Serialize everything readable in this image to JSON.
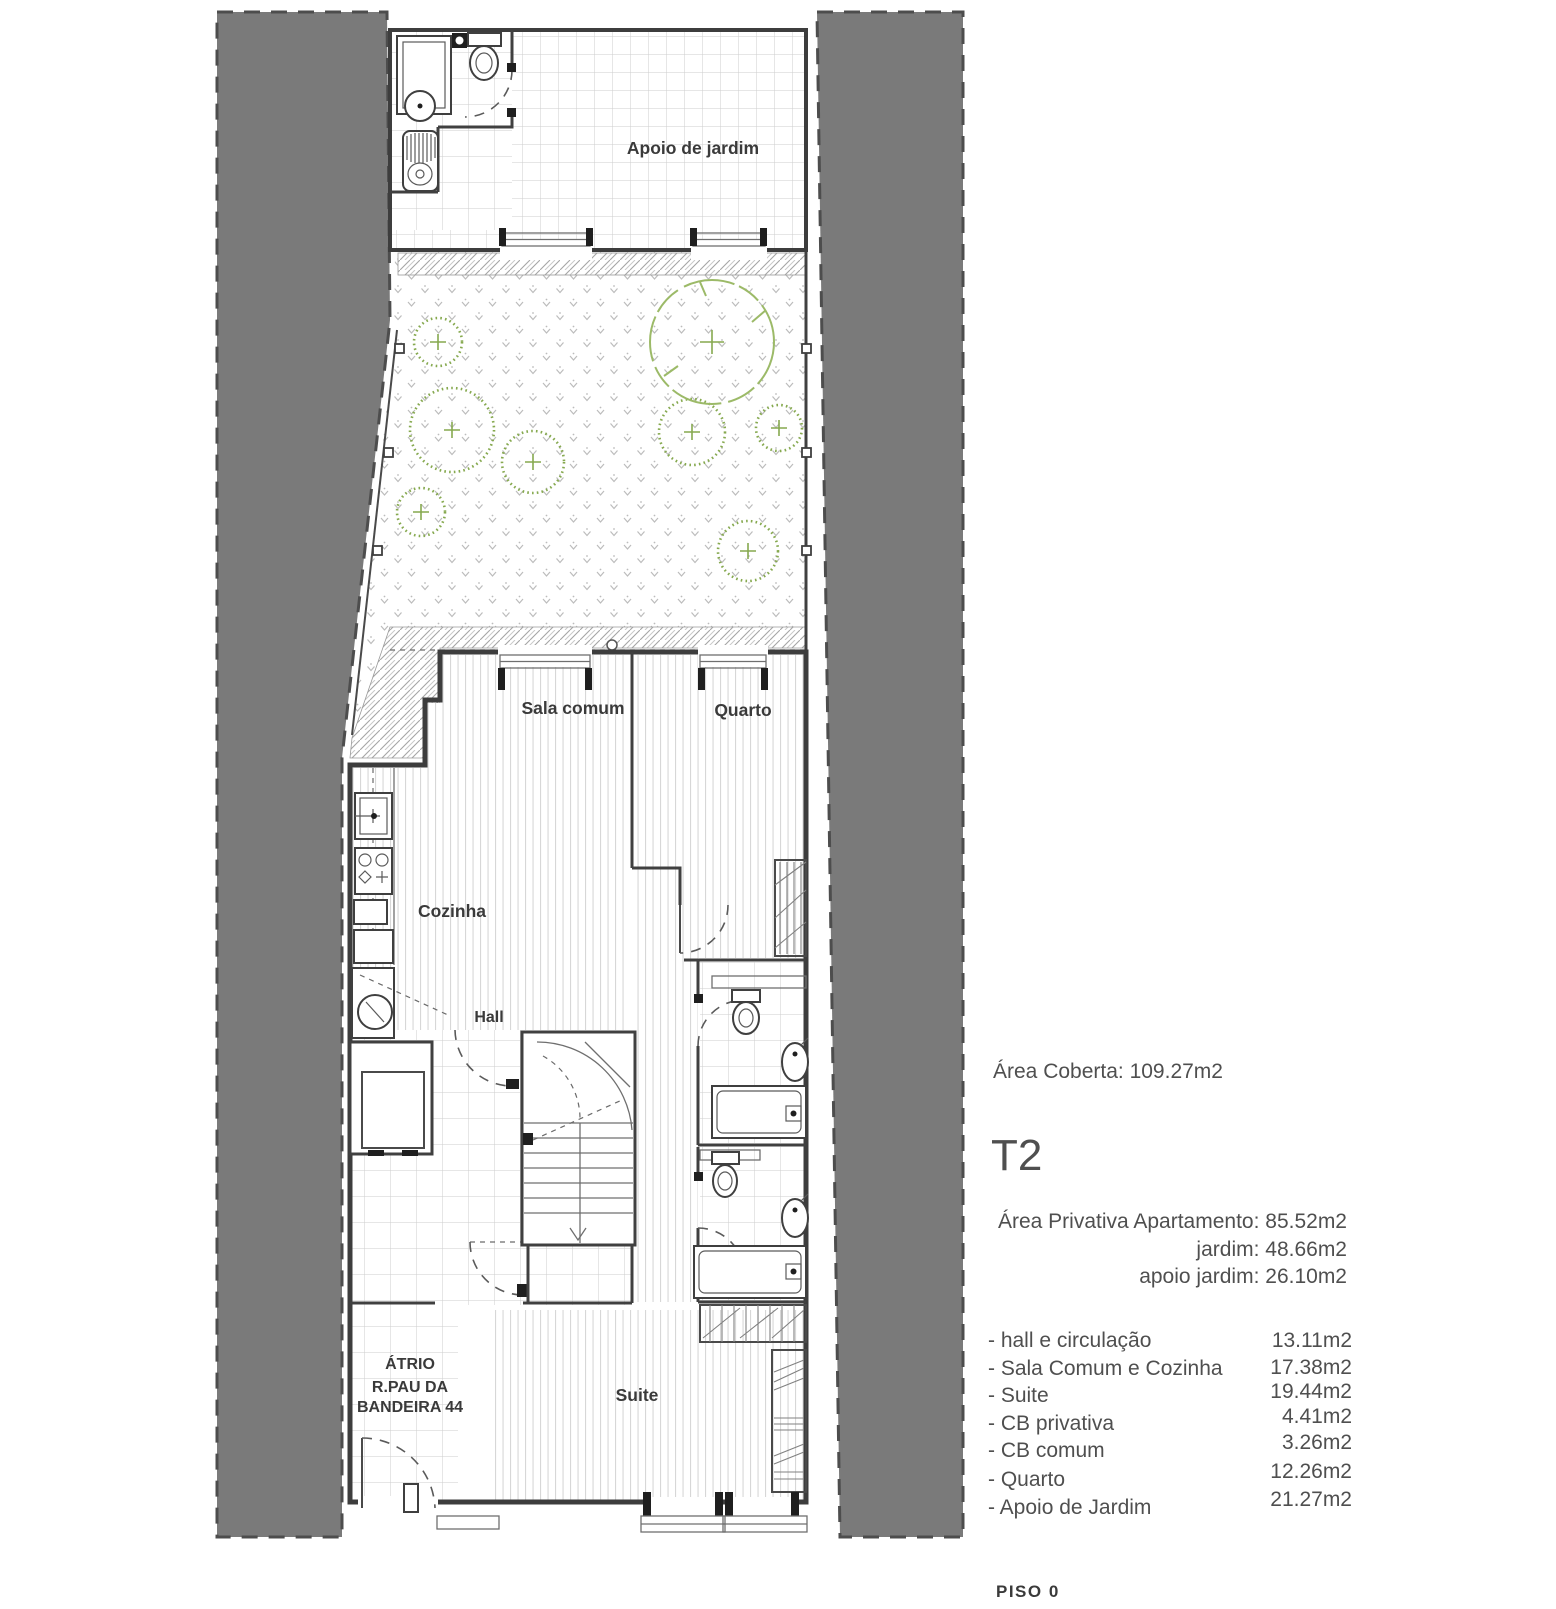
{
  "page": {
    "floor_label": "PISO 0"
  },
  "plan": {
    "rooms": {
      "apoio_de_jardim": "Apoio de jardim",
      "sala_comum": "Sala comum",
      "quarto": "Quarto",
      "cozinha": "Cozinha",
      "hall": "Hall",
      "suite": "Suite",
      "atrio_line1": "ÁTRIO",
      "atrio_line2": "R.PAU DA",
      "atrio_line3": "BANDEIRA 44"
    }
  },
  "info_panel": {
    "area_coberta": "Área Coberta: 109.27m2",
    "unit_type": "T2",
    "private_areas": [
      "Área Privativa Apartamento: 85.52m2",
      "jardim: 48.66m2",
      "apoio jardim: 26.10m2"
    ],
    "room_areas": [
      {
        "label": "- hall e circulação",
        "value": "13.11m2"
      },
      {
        "label": "- Sala Comum e Cozinha",
        "value": "17.38m2"
      },
      {
        "label": "- Suite",
        "value": "19.44m2"
      },
      {
        "label": "- CB privativa",
        "value": "4.41m2"
      },
      {
        "label": "- CB comum",
        "value": "3.26m2"
      },
      {
        "label": "- Quarto",
        "value": "12.26m2"
      },
      {
        "label": "- Apoio de Jardim",
        "value": "21.27m2"
      }
    ]
  },
  "colors": {
    "setback_gray": "#7a7a7a",
    "boundary_dash": "#4d4d4d",
    "wall": "#3d3d3d",
    "shrub_green": "#86a94f",
    "tree_green": "#9cba68",
    "label_text": "#3a3a3a",
    "panel_text": "#4f4f4f"
  }
}
